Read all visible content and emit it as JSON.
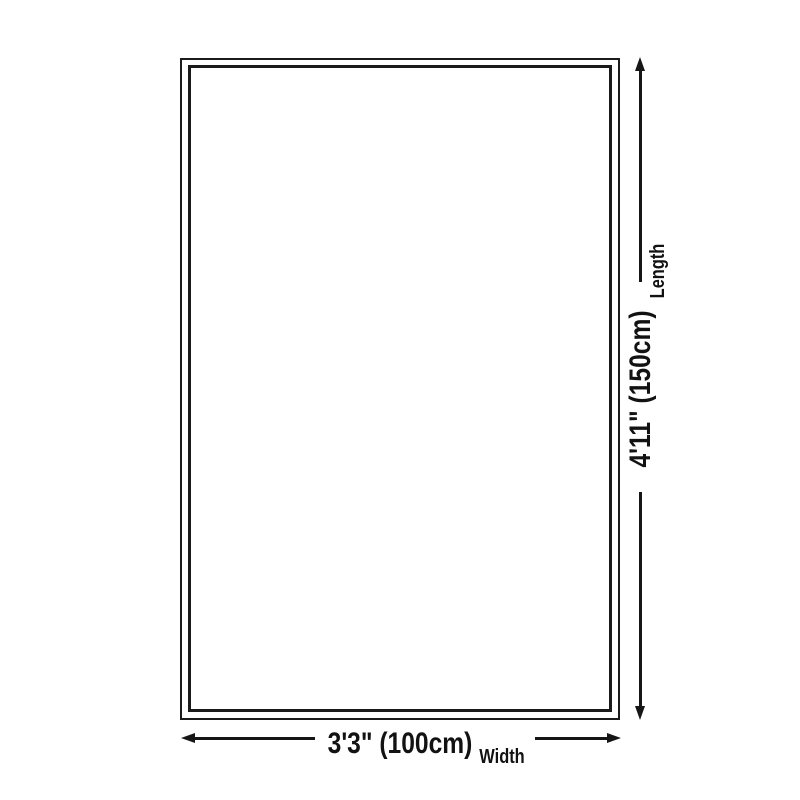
{
  "diagram": {
    "kind": "rug-size-dimension-diagram",
    "length": {
      "value": "4'11\" (150cm)",
      "label": "Length"
    },
    "width": {
      "value": "3'3\" (100cm)",
      "label": "Width"
    },
    "colors": {
      "ink": "#161616",
      "background": "#ffffff"
    }
  }
}
